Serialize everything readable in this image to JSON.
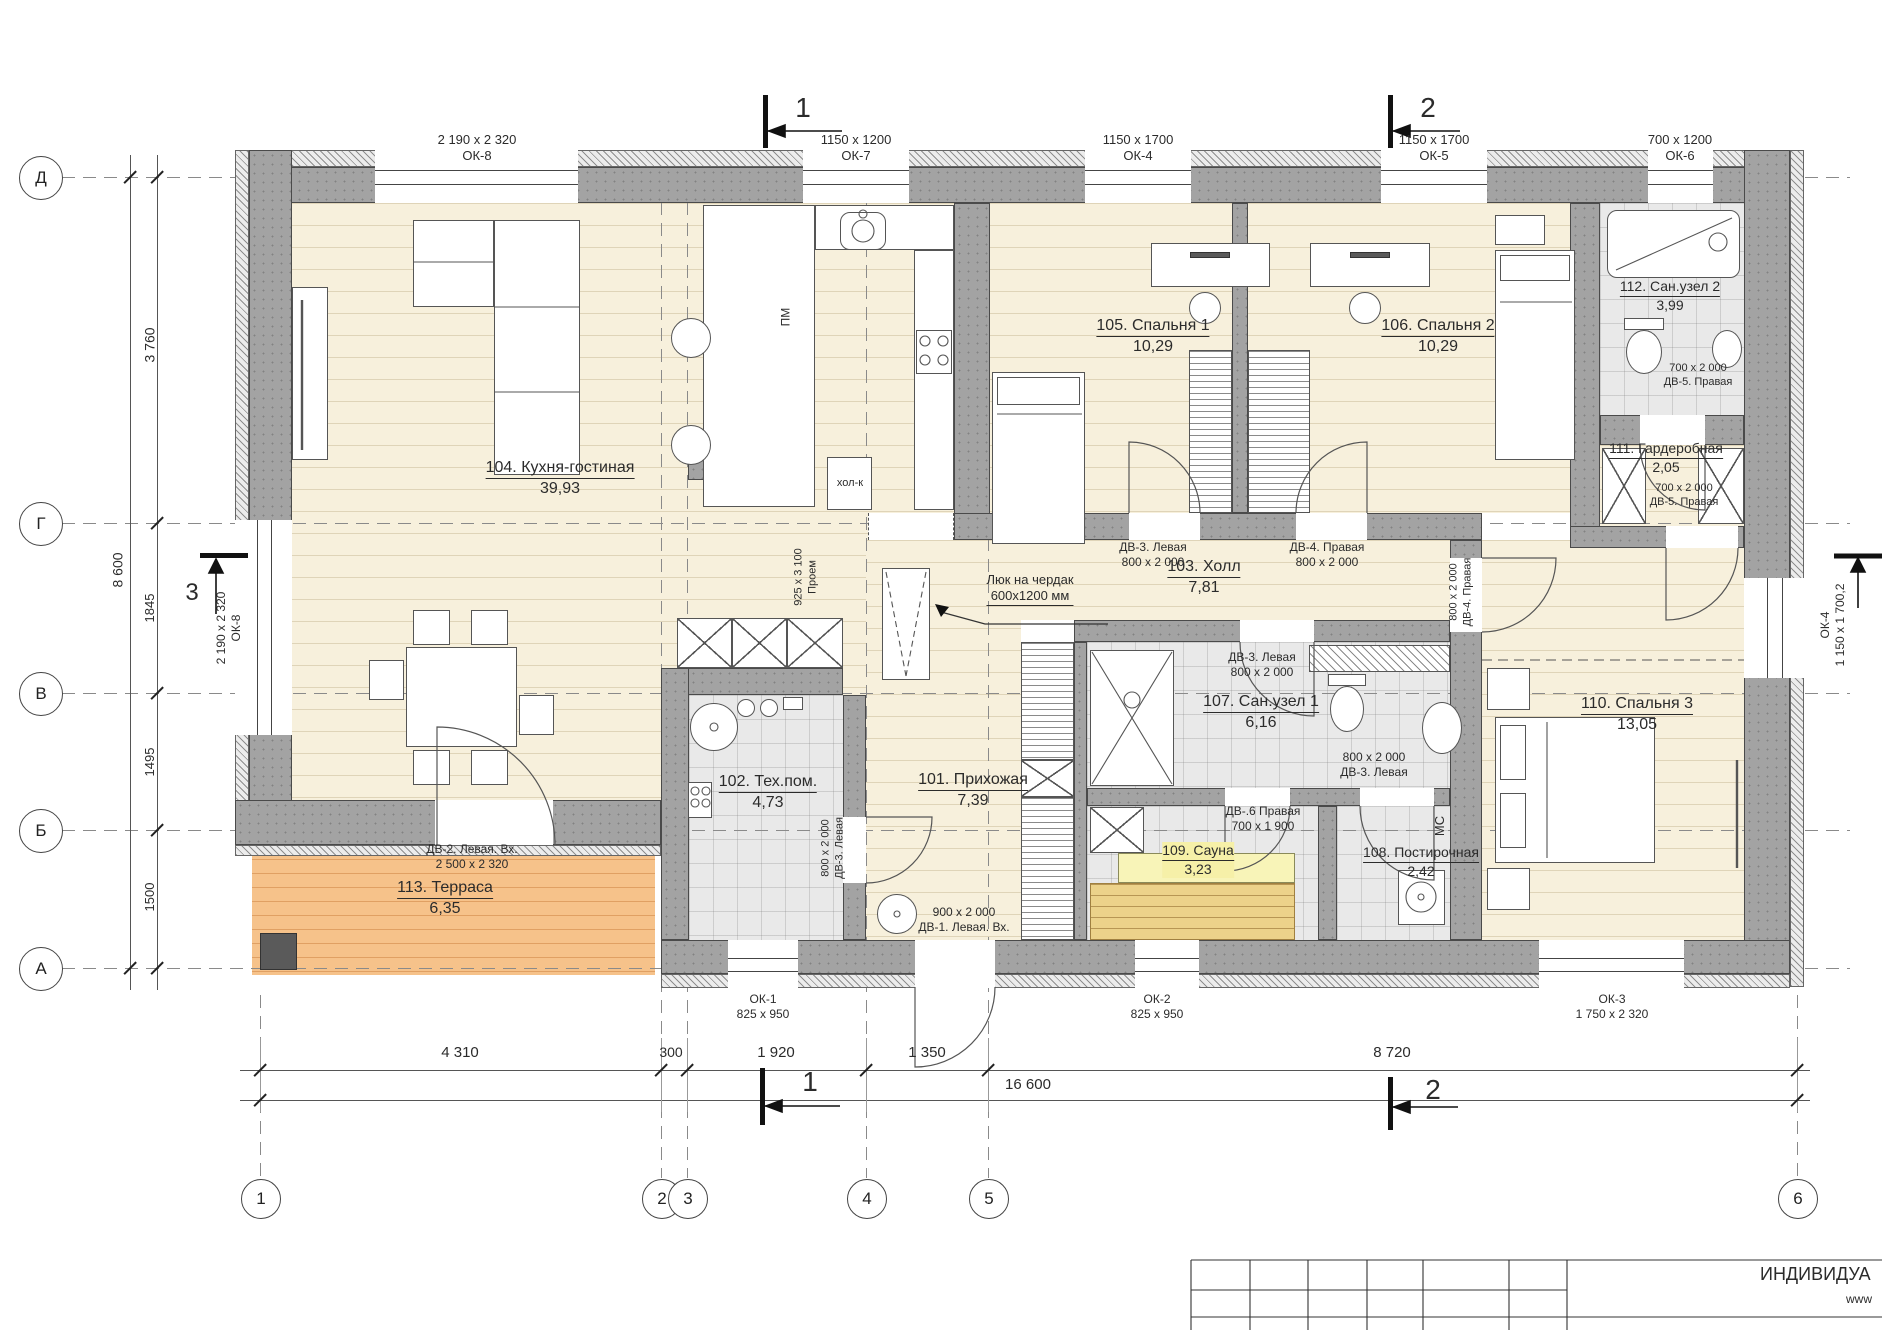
{
  "drawing": {
    "type": "architectural floor plan",
    "grid": {
      "rows": [
        "Д",
        "Г",
        "В",
        "Б",
        "А"
      ],
      "cols": [
        "1",
        "2",
        "3",
        "4",
        "5",
        "6"
      ]
    },
    "title_block": {
      "org_line": "ИНДИВИДУА",
      "site_line": "www"
    }
  },
  "annotations": [
    {
      "n": "window-label-ok8-top",
      "l": [
        "2 190 x 2 320",
        "ОК-8"
      ],
      "x": 477,
      "y": 132,
      "s": 13
    },
    {
      "n": "window-label-ok7-top",
      "l": [
        "1150 x 1200",
        "ОК-7"
      ],
      "x": 856,
      "y": 132,
      "s": 13
    },
    {
      "n": "window-label-ok4-top",
      "l": [
        "1150 x 1700",
        "ОК-4"
      ],
      "x": 1138,
      "y": 132,
      "s": 13
    },
    {
      "n": "window-label-ok5-top",
      "l": [
        "1150 x 1700",
        "ОК-5"
      ],
      "x": 1434,
      "y": 132,
      "s": 13
    },
    {
      "n": "window-label-ok6-top",
      "l": [
        "700 x 1200",
        "ОК-6"
      ],
      "x": 1680,
      "y": 132,
      "s": 13
    },
    {
      "n": "section-1-top-label",
      "l": [
        "1"
      ],
      "x": 803,
      "y": 90,
      "s": 28
    },
    {
      "n": "section-2-top-label",
      "l": [
        "2"
      ],
      "x": 1428,
      "y": 90,
      "s": 28
    },
    {
      "n": "section-1-bottom-label",
      "l": [
        "1"
      ],
      "x": 810,
      "y": 1064,
      "s": 28
    },
    {
      "n": "section-2-bottom-label",
      "l": [
        "2"
      ],
      "x": 1433,
      "y": 1072,
      "s": 28
    },
    {
      "n": "section-3-left-label",
      "l": [
        "3"
      ],
      "x": 192,
      "y": 578,
      "s": 24
    },
    {
      "n": "dim-3760",
      "l": [
        "3 760"
      ],
      "x": 150,
      "y": 345,
      "r": -90,
      "s": 14
    },
    {
      "n": "dim-8600",
      "l": [
        "8 600"
      ],
      "x": 118,
      "y": 570,
      "r": -90,
      "s": 14
    },
    {
      "n": "dim-1845",
      "l": [
        "1845"
      ],
      "x": 150,
      "y": 608,
      "r": -90,
      "s": 13
    },
    {
      "n": "dim-1495",
      "l": [
        "1495"
      ],
      "x": 150,
      "y": 762,
      "r": -90,
      "s": 13
    },
    {
      "n": "dim-1500",
      "l": [
        "1500"
      ],
      "x": 150,
      "y": 897,
      "r": -90,
      "s": 13
    },
    {
      "n": "window-label-ok8-left",
      "l": [
        "2 190 x 2 320",
        "ОК-8"
      ],
      "x": 229,
      "y": 628,
      "r": -90,
      "s": 12
    },
    {
      "n": "window-label-ok4-right",
      "l": [
        "ОК-4",
        "1 150 x 1 700,2"
      ],
      "x": 1833,
      "y": 625,
      "r": -90,
      "s": 12
    },
    {
      "n": "dim-4310",
      "l": [
        "4 310"
      ],
      "x": 460,
      "y": 1044,
      "s": 15
    },
    {
      "n": "dim-300",
      "l": [
        "300"
      ],
      "x": 671,
      "y": 1044,
      "s": 14
    },
    {
      "n": "dim-1920",
      "l": [
        "1 920"
      ],
      "x": 776,
      "y": 1044,
      "s": 15
    },
    {
      "n": "dim-1350",
      "l": [
        "1 350"
      ],
      "x": 927,
      "y": 1044,
      "s": 15
    },
    {
      "n": "dim-8720",
      "l": [
        "8 720"
      ],
      "x": 1392,
      "y": 1044,
      "s": 15
    },
    {
      "n": "dim-16600",
      "l": [
        "16 600"
      ],
      "x": 1028,
      "y": 1076,
      "s": 15
    },
    {
      "n": "window-label-ok1",
      "l": [
        "ОК-1",
        "825 x 950"
      ],
      "x": 763,
      "y": 992,
      "s": 12
    },
    {
      "n": "window-label-ok2",
      "l": [
        "ОК-2",
        "825 x 950"
      ],
      "x": 1157,
      "y": 992,
      "s": 12
    },
    {
      "n": "window-label-ok3",
      "l": [
        "ОК-3",
        "1 750 x 2 320"
      ],
      "x": 1612,
      "y": 992,
      "s": 12
    },
    {
      "n": "room-label-104",
      "l": [
        "104. Кухня-гостиная",
        "39,93"
      ],
      "x": 560,
      "y": 458,
      "s": 16,
      "u": 1
    },
    {
      "n": "room-label-105",
      "l": [
        "105. Спальня 1",
        "10,29"
      ],
      "x": 1153,
      "y": 316,
      "s": 16,
      "u": 1
    },
    {
      "n": "room-label-106",
      "l": [
        "106. Спальня 2",
        "10,29"
      ],
      "x": 1438,
      "y": 316,
      "s": 16,
      "u": 1
    },
    {
      "n": "room-label-112",
      "l": [
        "112. Сан.узел 2",
        "3,99"
      ],
      "x": 1670,
      "y": 278,
      "s": 14,
      "u": 1
    },
    {
      "n": "room-label-111",
      "l": [
        "111. Гардеробная",
        "2,05"
      ],
      "x": 1666,
      "y": 440,
      "s": 14,
      "u": 1
    },
    {
      "n": "room-label-103",
      "l": [
        "103. Холл",
        "7,81"
      ],
      "x": 1204,
      "y": 557,
      "s": 16,
      "u": 1
    },
    {
      "n": "room-label-101",
      "l": [
        "101. Прихожая",
        "7,39"
      ],
      "x": 973,
      "y": 770,
      "s": 16,
      "u": 1
    },
    {
      "n": "room-label-102",
      "l": [
        "102. Тех.пом.",
        "4,73"
      ],
      "x": 768,
      "y": 772,
      "s": 16,
      "u": 1
    },
    {
      "n": "room-label-107",
      "l": [
        "107. Сан.узел 1",
        "6,16"
      ],
      "x": 1261,
      "y": 692,
      "s": 16,
      "u": 1
    },
    {
      "n": "room-label-109",
      "l": [
        "109. Сауна",
        "3,23"
      ],
      "x": 1198,
      "y": 842,
      "s": 14,
      "u": 1,
      "bg": "#f6f0a8"
    },
    {
      "n": "room-label-108",
      "l": [
        "108. Постирочная",
        "2,42"
      ],
      "x": 1421,
      "y": 844,
      "s": 14,
      "u": 1
    },
    {
      "n": "room-label-110",
      "l": [
        "110. Спальня 3",
        "13,05"
      ],
      "x": 1637,
      "y": 694,
      "s": 16,
      "u": 1
    },
    {
      "n": "room-label-113",
      "l": [
        "113. Терраса",
        "6,35"
      ],
      "x": 445,
      "y": 878,
      "s": 16,
      "u": 1
    },
    {
      "n": "door-label-dv2",
      "l": [
        "ДВ-2. Левая. Вх.",
        "2 500 x 2 320"
      ],
      "x": 472,
      "y": 842,
      "s": 12
    },
    {
      "n": "door-label-dv1",
      "l": [
        "900 x 2 000",
        "ДВ-1. Левая. Вх."
      ],
      "x": 964,
      "y": 905,
      "s": 12
    },
    {
      "n": "door-label-dv3-bedroom1",
      "l": [
        "ДВ-3. Левая",
        "800 x 2 000"
      ],
      "x": 1153,
      "y": 540,
      "s": 12
    },
    {
      "n": "door-label-dv4-bedroom2",
      "l": [
        "ДВ-4. Правая",
        "800 x 2 000"
      ],
      "x": 1327,
      "y": 540,
      "s": 12
    },
    {
      "n": "door-label-dv3-san1",
      "l": [
        "ДВ-3. Левая",
        "800 x 2 000"
      ],
      "x": 1262,
      "y": 650,
      "s": 12
    },
    {
      "n": "door-label-dv3-post",
      "l": [
        "800 x 2 000",
        "ДВ-3. Левая"
      ],
      "x": 1374,
      "y": 750,
      "s": 12
    },
    {
      "n": "door-label-dv6-sauna",
      "l": [
        "ДВ-.6 Правая",
        "700 x 1 900"
      ],
      "x": 1263,
      "y": 804,
      "s": 12
    },
    {
      "n": "door-label-dv5-san2",
      "l": [
        "700 x 2 000",
        "ДВ-5. Правая"
      ],
      "x": 1698,
      "y": 362,
      "s": 11
    },
    {
      "n": "door-label-dv5-gard",
      "l": [
        "700 x 2 000",
        "ДВ-5. Правая"
      ],
      "x": 1684,
      "y": 482,
      "s": 11
    },
    {
      "n": "door-label-dv3-tech",
      "l": [
        "800 x 2 000",
        "ДВ-3. Левая"
      ],
      "x": 833,
      "y": 848,
      "r": -90,
      "s": 11
    },
    {
      "n": "door-label-dv4-bedroom3",
      "l": [
        "800 x 2 000",
        "ДВ-4. Правая"
      ],
      "x": 1461,
      "y": 592,
      "r": -90,
      "s": 11
    },
    {
      "n": "opening-label-proem",
      "l": [
        "925 x 3 100",
        "Проем"
      ],
      "x": 806,
      "y": 577,
      "r": -90,
      "s": 11
    },
    {
      "n": "attic-hatch-label",
      "l": [
        "Люк на чердак",
        "600х1200 мм"
      ],
      "x": 1030,
      "y": 572,
      "s": 13,
      "lb": 1
    },
    {
      "n": "fridge-label",
      "l": [
        "хол-к"
      ],
      "x": 850,
      "y": 477,
      "s": 11
    },
    {
      "n": "dishwasher-label",
      "l": [
        "ПМ"
      ],
      "x": 786,
      "y": 317,
      "r": -90,
      "s": 12
    },
    {
      "n": "washer-place-label",
      "l": [
        "МС"
      ],
      "x": 1440,
      "y": 826,
      "r": -90,
      "s": 13
    }
  ]
}
